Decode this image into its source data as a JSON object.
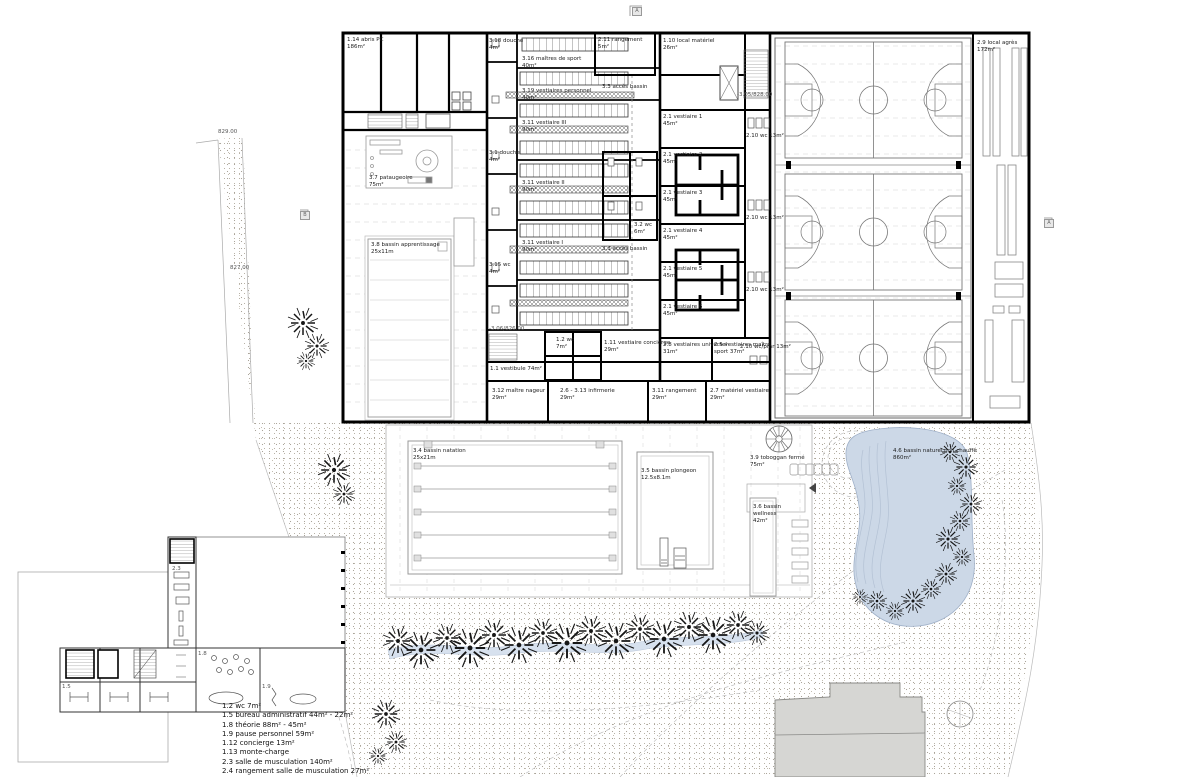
{
  "drawing": {
    "type": "architectural site plan",
    "level": "rez-de-chaussée piscine / salle de sport"
  },
  "colors": {
    "wall": "#000000",
    "pond_water": "#ccd8e7",
    "stream_water": "#d7e1ee",
    "terrain_dot": "#aaa49a",
    "existing_building": "#d6d6d3",
    "line_gray": "#999999"
  },
  "legend": {
    "lines": [
      "1.2 wc 7m²",
      "1.5 bureau administratif 44m² - 22m²",
      "1.8 théorie 88m² - 45m²",
      "1.9 pause personnel 59m²",
      "1.12 concierge 13m²",
      "1.13 monte-charge",
      "2.3 salle de musculation 140m²",
      "2.4 rangement salle de musculation 27m²"
    ]
  },
  "labels": {
    "abris_pc": "1.14 abris PC\n186m²",
    "local_agres": "2.9 local agrès\n172m²",
    "rangement_211": "2.11 rangement\n5m²",
    "local_materiel": "1.10 local matériel\n26m²",
    "v1": "2.1 vestiaire 1\n45m²",
    "v2": "2.1 vestiaire 2\n45m²",
    "v3": "2.1 vestiaire 3\n45m²",
    "v4": "2.1 vestiaire 4\n45m²",
    "v5": "2.1 vestiaire 5\n45m²",
    "v6": "2.1 vestiaire 6\n45m²",
    "wc13_a": "2.10 wc 13m²",
    "wc13_b": "2.10 wc 13m²",
    "wc13_c": "2.10 wc 13m²",
    "wc_pmr": "2.10 wc/pmr 13m²",
    "vest_universel": "2.8 vestiaires universel\n31m²",
    "vest_maitre": "2.5 vestiaires maître\nsport 37m²",
    "maitres_sport": "3.16 maîtres de sport\n40m²",
    "vest_personnel": "3.19 vestiaires personnel\n40m²",
    "vest_iii": "3.11 vestiaire III\n90m²",
    "vest_ii": "3.11 vestiaire II\n90m²",
    "vest_i": "3.11 vestiaire I\n90m²",
    "acces_bassin_a": "3.3 accès bassin",
    "acces_bassin_b": "3.3 accès bassin",
    "wc32": "3.2 wc\n6m²",
    "douche318": "3.18 douche\n4m²",
    "douche31": "3.1 douche\n4m²",
    "wc315": "3.15 wc\n4m²",
    "vestibule": "1.1 vestibule 74m²",
    "wc12": "1.2 wc\n7m²",
    "vest_concierge": "1.11 vestiaire concierge\n29m²",
    "lvl826": "-3.06/826.00",
    "lvl828": "-3.05/828.00",
    "maitre_nageur": "3.12 maître nageur\n29m²",
    "infirmerie": "2.6 - 3.13 infirmerie\n29m²",
    "rangement311": "3.11 rangement\n29m²",
    "materiel_vest": "2.7 matériel vestiaire\n29m²",
    "pataugeoire": "3.7 pataugeoire\n75m²",
    "apprentissage": "3.8 bassin apprentissage\n25x11m",
    "natation": "3.4 bassin natation\n25x21m",
    "plongeon": "3.5 bassin plongeon\n12.5x8.1m",
    "toboggan": "3.9 toboggan fermé\n75m²",
    "wellness": "3.6 bassin\nwellness\n42m²",
    "biotope": "4.6 bassin naturel non chauffé\n860m²",
    "elev_829": "829.00",
    "elev_827": "827.00",
    "n15": "1.5",
    "n18": "1.8",
    "n19": "1.9",
    "n23": "2.3",
    "marker_a_top": "A",
    "marker_a_right": "A",
    "marker_b_left": "B"
  },
  "sports_hall": {
    "basketball_courts": 3
  },
  "pools": {
    "lanes_natation": 6
  }
}
